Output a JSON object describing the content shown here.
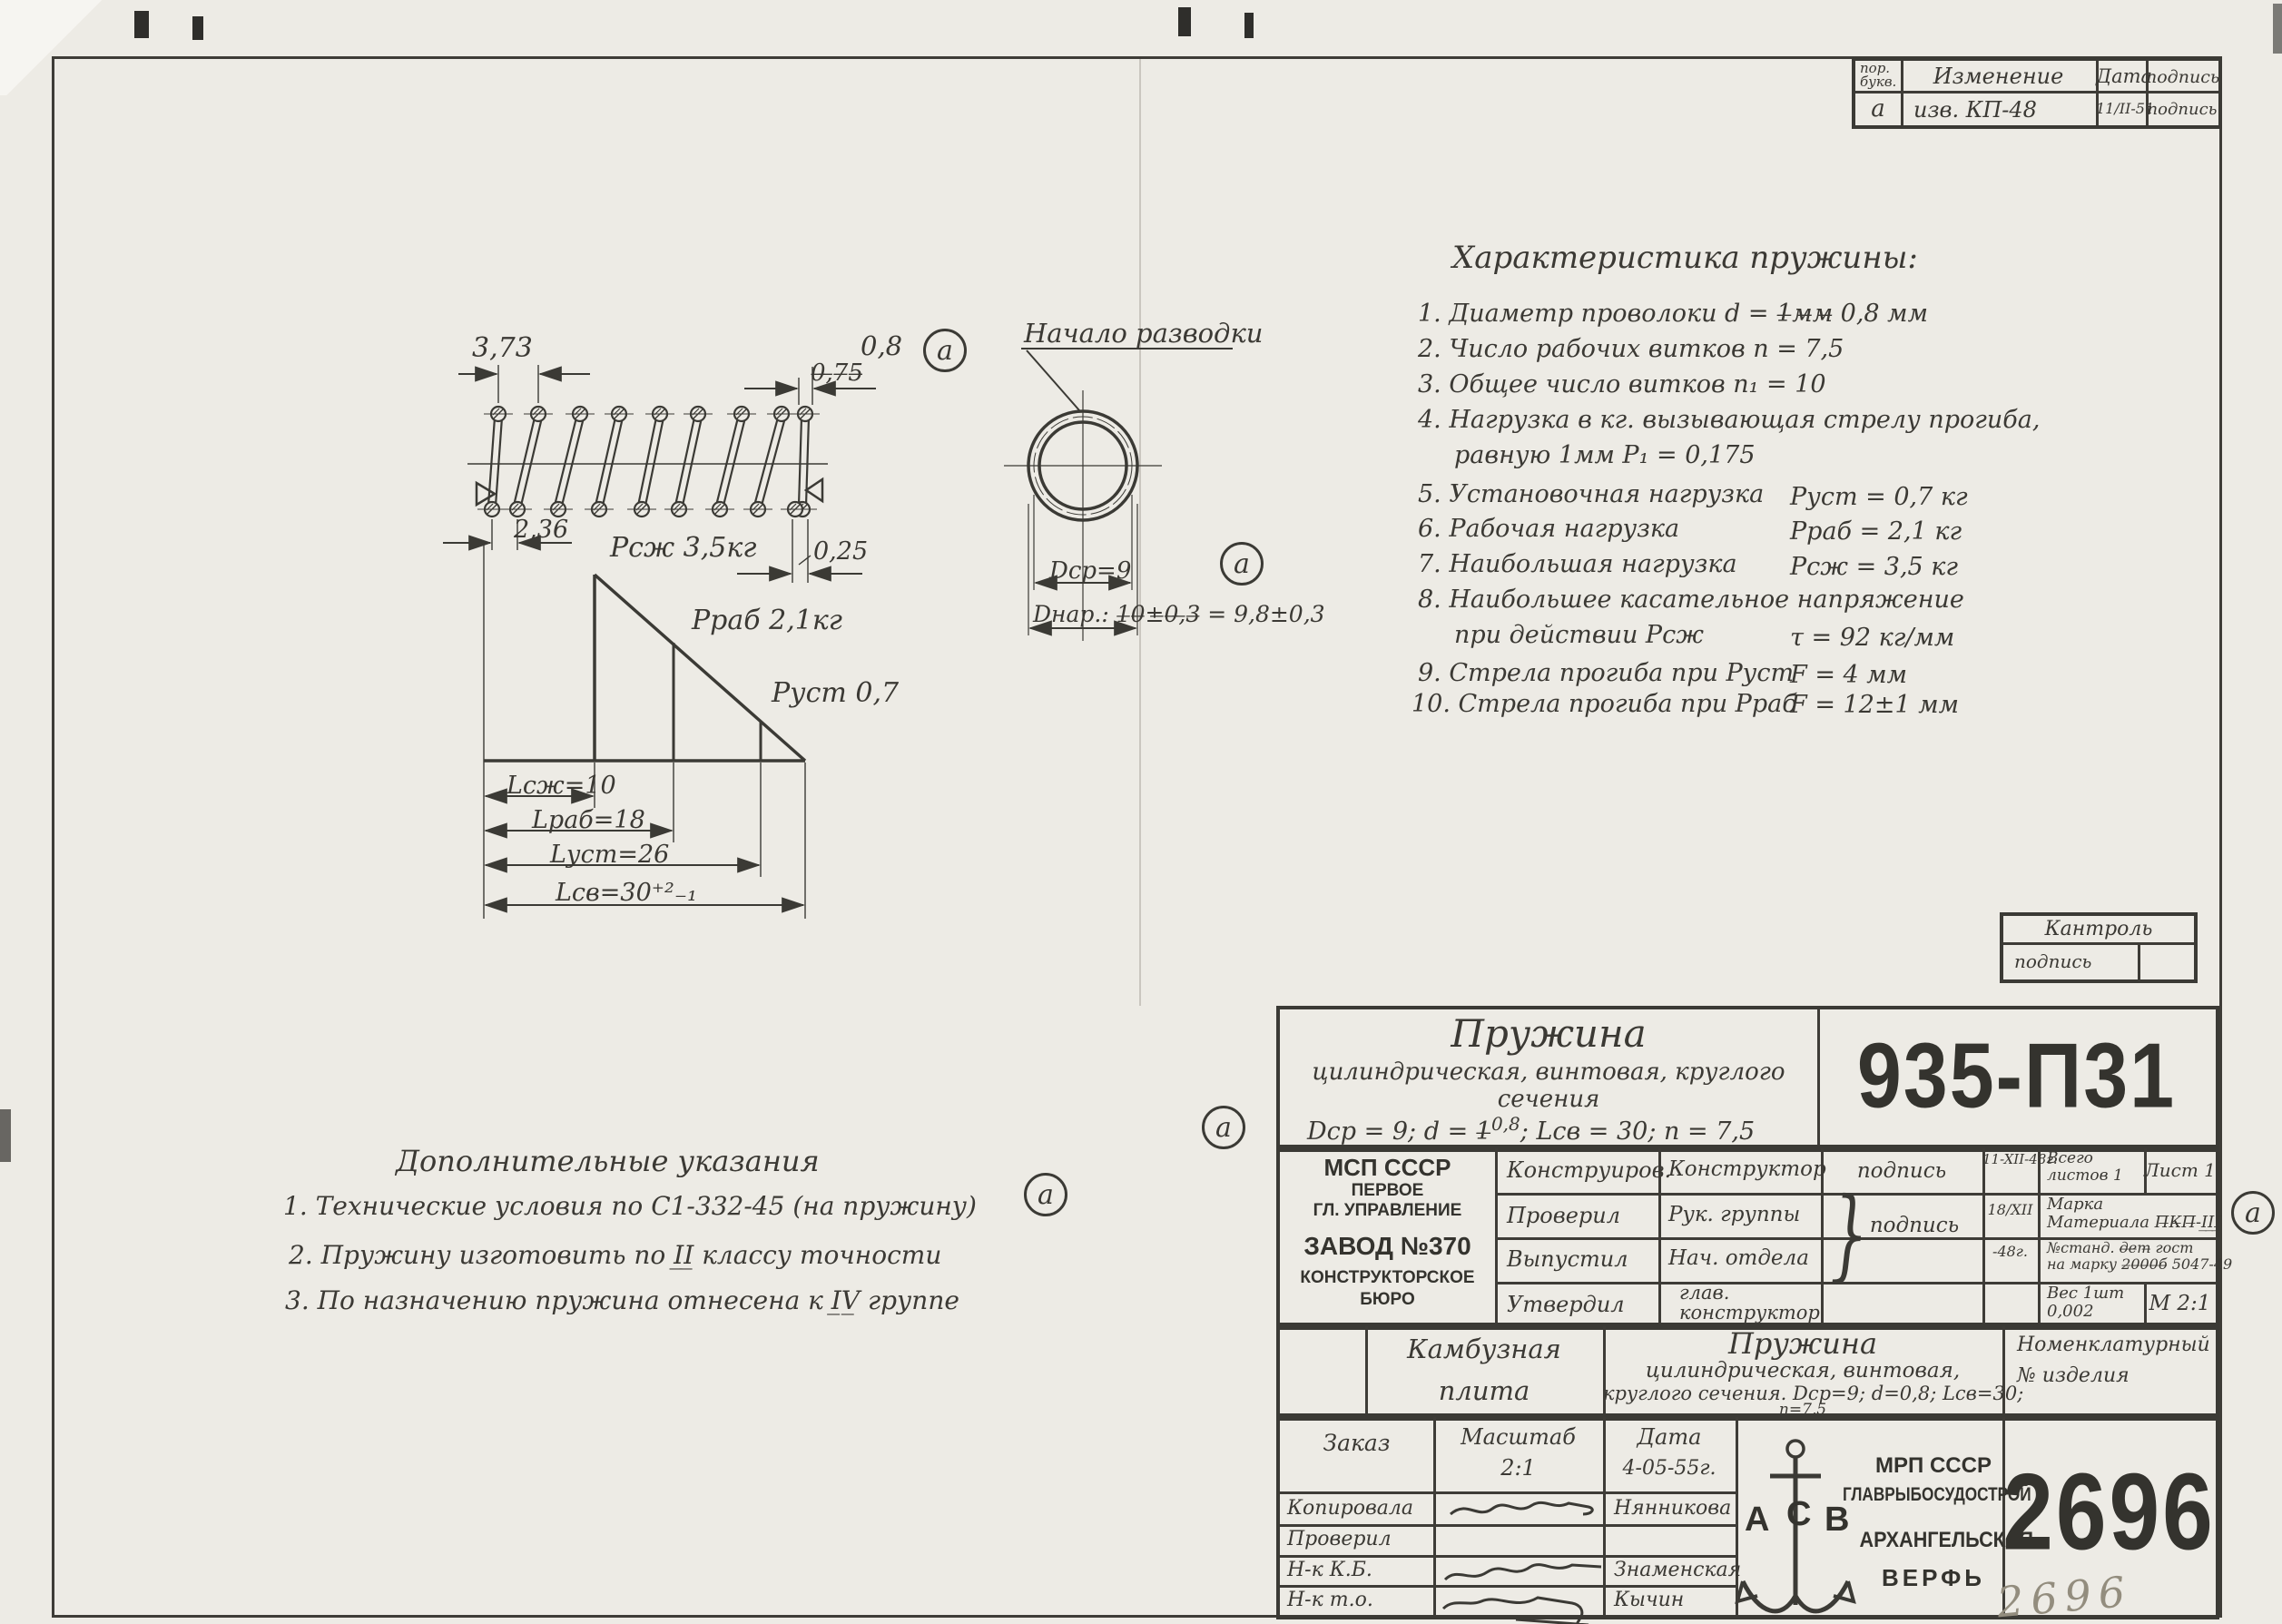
{
  "sheet": {
    "marker": "а",
    "pencil_number": "2696"
  },
  "revision_table": {
    "h_col1a": "пор.",
    "h_col1b": "букв.",
    "h_change": "Изменение",
    "h_date": "Дата",
    "h_sign": "подпись",
    "r_letter": "а",
    "r_change": "изв. КП-48",
    "r_date": "11/II-51",
    "r_sign": "подпись"
  },
  "spring_view": {
    "dim_pitch": "3,73",
    "dim_wire_new": "0,8",
    "dim_wire_old": "0̶,̶7̶5̶",
    "dim_end": "2,36",
    "dim_tip": "0,25",
    "load_max": "Рсж 3,5кг",
    "load_work": "Рраб 2,1кг",
    "load_set": "Руст 0,7",
    "len_comp": "Lсж=10",
    "len_work": "Lраб=18",
    "len_set": "Lуст=26",
    "len_free": "Lсв=30⁺²₋₁"
  },
  "circle_view": {
    "label": "Начало разводки",
    "dim_mean": "Dср=9",
    "dim_outer": "Dнар.: 1̶0̶±̶0̶,̶3̶ = 9,8±0,3"
  },
  "characteristics": {
    "title": "Характеристика пружины:",
    "items": [
      {
        "text": "1. Диаметр проволоки   d = 1̶м̶м̶ 0,8 мм",
        "value": ""
      },
      {
        "text": "2. Число рабочих витков   n = 7,5",
        "value": ""
      },
      {
        "text": "3. Общее число витков   n₁ = 10",
        "value": ""
      },
      {
        "text": "4. Нагрузка в кг. вызывающая стрелу прогиба,",
        "text2": "равную 1мм    Р₁ = 0,175",
        "value": ""
      },
      {
        "text": "5. Установочная нагрузка",
        "value": "Руст = 0,7 кг"
      },
      {
        "text": "6. Рабочая нагрузка",
        "value": "Рраб = 2,1 кг"
      },
      {
        "text": "7. Наибольшая нагрузка",
        "value": "Рсж = 3,5 кг"
      },
      {
        "text": "8. Наибольшее касательное напряжение",
        "text2": "при действии    Рсж",
        "value": "τ = 92 кг/мм"
      },
      {
        "text": "9. Стрела прогиба при Руст",
        "value": "F = 4 мм"
      },
      {
        "text": "10. Стрела прогиба при Рраб",
        "value": "F = 12±1 мм"
      }
    ]
  },
  "notes": {
    "title": "Дополнительные указания",
    "item1": "1. Технические условия по С1-332-45 (на пружину)",
    "item2": "2. Пружину изготовить по I̲I̲ классу точности",
    "item3": "3. По назначению пружина отнесена к I̲V̲ группе"
  },
  "control_box": {
    "title": "Кантроль",
    "sign": "подпись"
  },
  "title_block": {
    "name": "Пружина",
    "sub1": "цилиндрическая, винтовая, круглого",
    "sub2": "сечения",
    "params_pre": "Dср = 9;  d = 1̶",
    "params_sup": "0,8",
    "params_post": ";  Lсв = 30;  n = 7,5",
    "number": "935-П31",
    "org1": "МСП СССР",
    "org2": "ПЕРВОЕ",
    "org3": "ГЛ. УПРАВЛЕНИЕ",
    "org4": "ЗАВОД №370",
    "org5": "КОНСТРУКТОРСКОЕ",
    "org6": "БЮРО",
    "row1_stage": "Конструиров.",
    "row1_role": "Конструктор",
    "row1_sign": "подпись",
    "row1_date": "11-XII-48г.",
    "row2_stage": "Проверил",
    "row2_role": "Рук. группы",
    "row2_sign": "подпись",
    "row2_date": "18/XII",
    "row3_stage": "Выпустил",
    "row3_role": "Нач. отдела",
    "row3_date": "-48г.",
    "row4_stage": "Утвердил",
    "row4_role1": "глав.",
    "row4_role2": "конструктор",
    "sheets1": "Всего",
    "sheets2": "листов 1",
    "sheet_no": "Лист 1",
    "mat1": "Марка",
    "mat2": "Материала П̶К̶П̶-I̲I̲I̲",
    "std1": "№станд. д̶е̶т̶ гост",
    "std2": "на марку 2̶0̶0̶0̶б̶ 5047-49",
    "weight1": "Вес 1шт",
    "weight2": "0,002",
    "scale": "М 2:1"
  },
  "product": {
    "unit1": "Камбузная",
    "unit2": "плита",
    "name": "Пружина",
    "desc1": "цилиндрическая, винтовая,",
    "desc2": "круглого сечения. Dср=9; d=0,8; Lсв=30;",
    "desc3": "n=7,5",
    "nom1": "Номенклатурный",
    "nom2": "№  изделия"
  },
  "stamp": {
    "order": "Заказ",
    "scale_label": "Масштаб",
    "scale": "2:1",
    "date_label": "Дата",
    "date": "4-05-55г.",
    "r1_label": "Копировала",
    "r1_name": "Нянникова",
    "r2_label": "Проверил",
    "r2_name": "",
    "r3_label": "Н-к К.Б.",
    "r3_name": "Знаменская",
    "r4_label": "Н-к т.о.",
    "r4_name": "Кычин",
    "logo_a": "А",
    "logo_c": "С",
    "logo_b": "В",
    "org1": "МРП СССР",
    "org2": "ГЛАВРЫБОСУДОСТРОЙ",
    "org3": "АРХАНГЕЛЬСКАЯ",
    "org4": "ВЕРФЬ",
    "number": "2696"
  }
}
